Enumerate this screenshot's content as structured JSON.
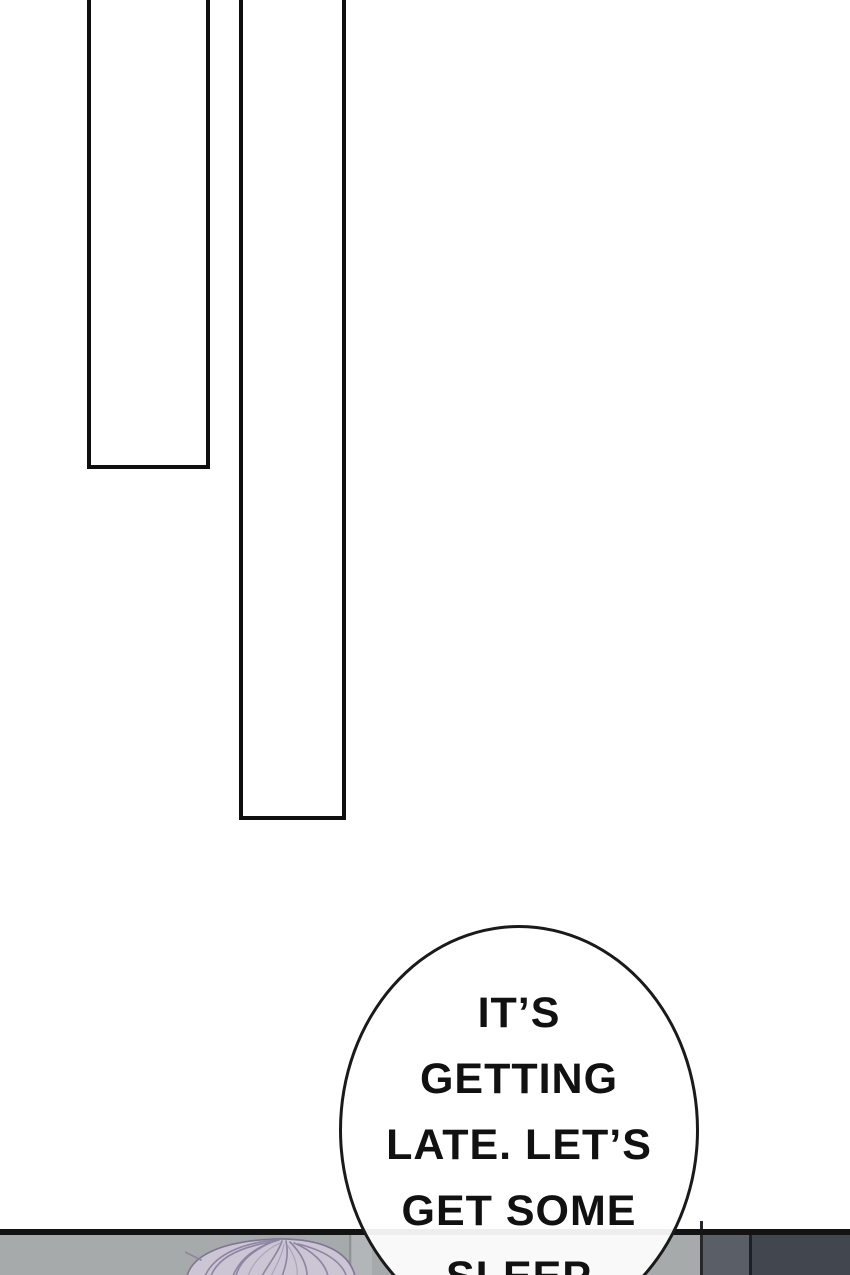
{
  "comic": {
    "speech_bubble": {
      "lines": [
        "IT’S",
        "GETTING",
        "LATE. LET’S",
        "GET SOME",
        "SLEEP"
      ]
    }
  },
  "colors": {
    "page_background": "#ffffff",
    "panel_border": "#0f0f0f",
    "bottom_panel_wall_left": "#a6aaab",
    "bottom_panel_wall_mid": "#5a5e66",
    "bottom_panel_wall_dark": "#42464e",
    "wall_divider": "#1e2025",
    "hair_base": "#cbc5d4",
    "hair_strand": "#8d85a1",
    "hair_outline": "#7e7693",
    "bubble_fill": "#ffffff",
    "bubble_stroke": "#1a1a1a"
  }
}
